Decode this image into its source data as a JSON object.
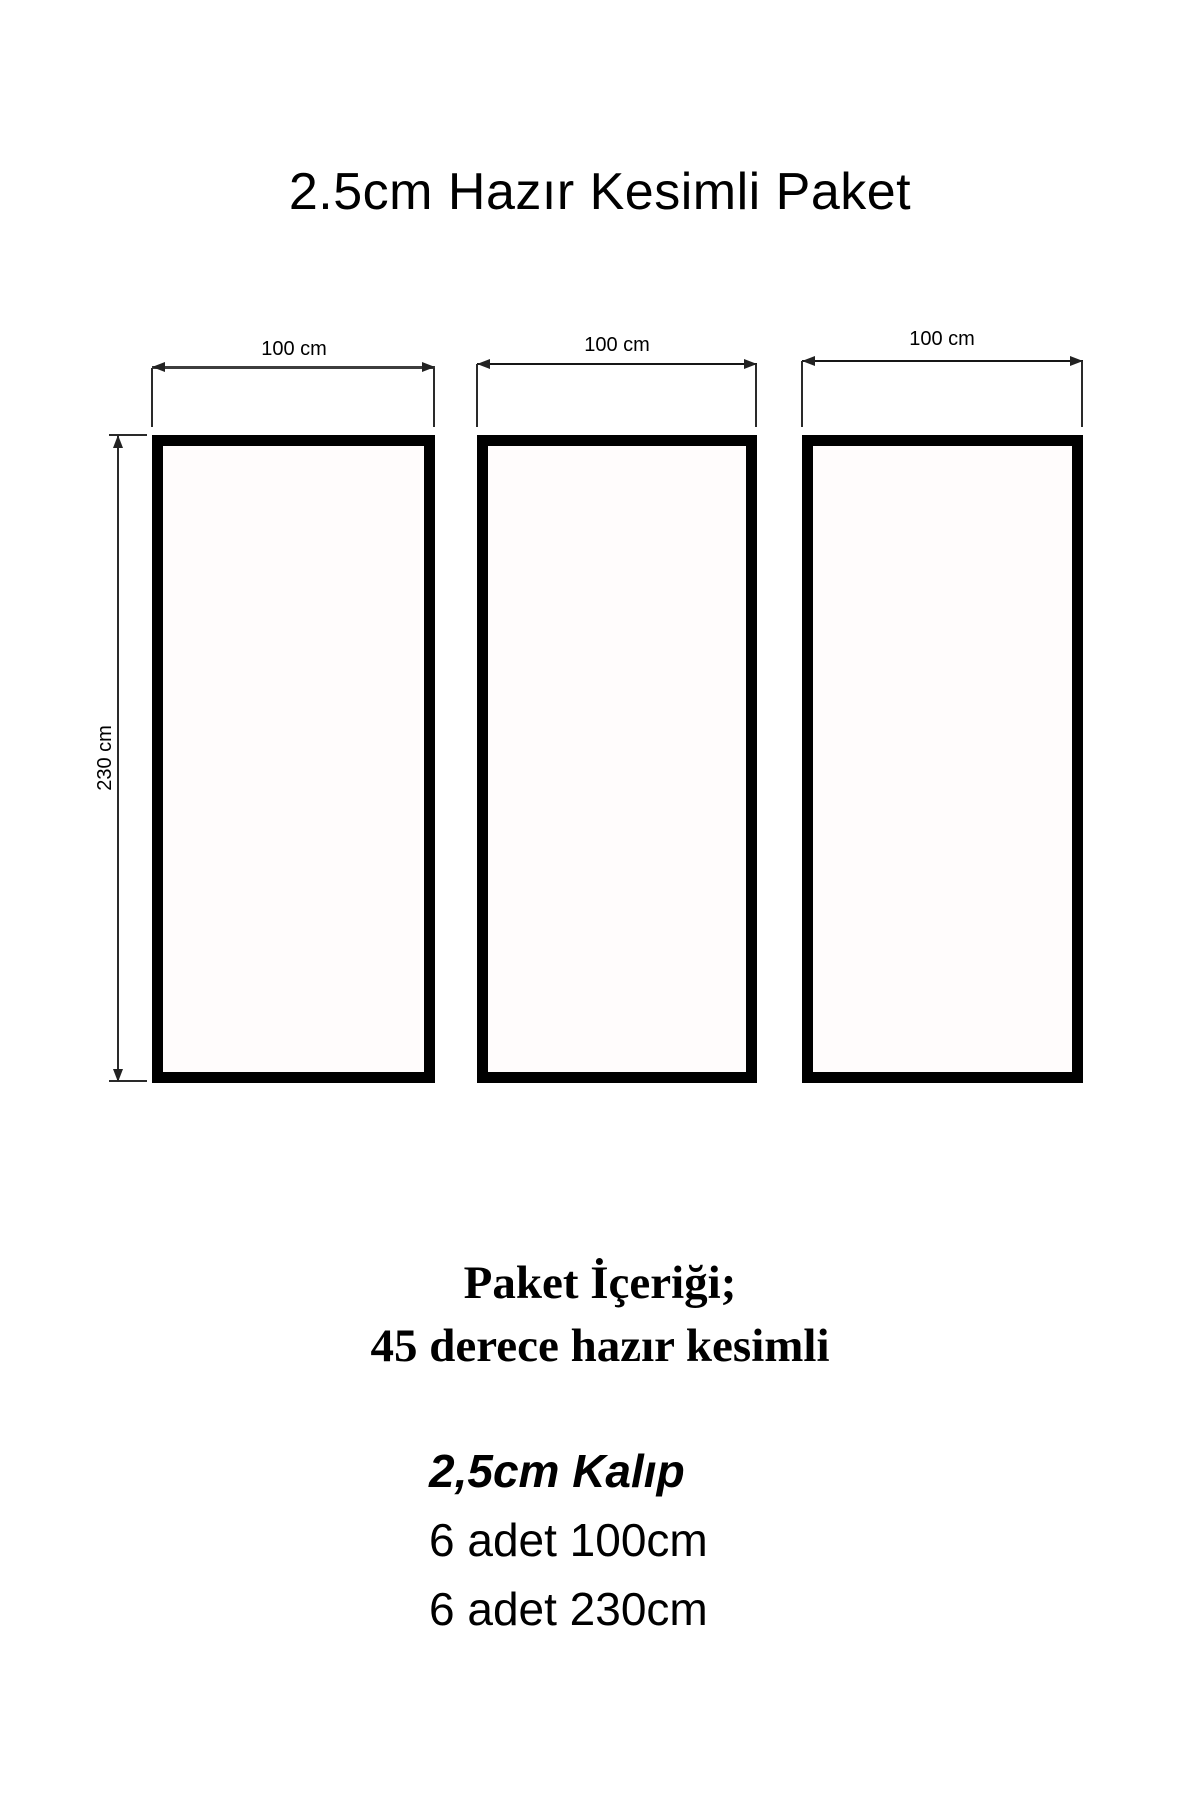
{
  "title": "2.5cm Hazır Kesimli Paket",
  "diagram": {
    "panels": [
      {
        "width_label": "100 cm"
      },
      {
        "width_label": "100 cm"
      },
      {
        "width_label": "100 cm"
      }
    ],
    "height_label": "230 cm",
    "panel_fill_color": "#fffcfc",
    "frame_color": "#000000",
    "dimension_line_color": "#2a2a2a"
  },
  "package": {
    "heading": "Paket İçeriği;",
    "subheading": "45 derece hazır kesimli",
    "mold_label": "2,5cm Kalıp",
    "items": [
      {
        "label": "6 adet 100cm"
      },
      {
        "label": "6 adet 230cm"
      }
    ]
  }
}
